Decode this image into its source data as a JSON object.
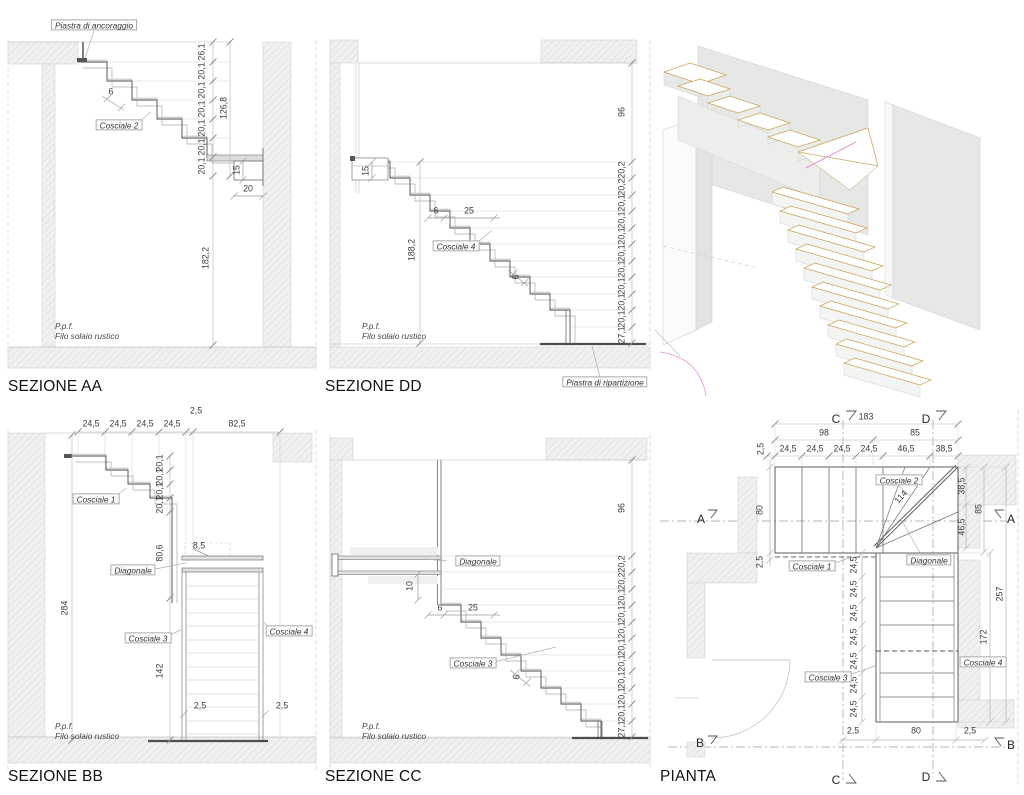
{
  "colors": {
    "hatch_line": "#d3d3d1",
    "wall_fill": "#f0f0ef",
    "line_main": "#6a6a6a",
    "line_dim": "#b4b4b4",
    "text": "#3a3a3a",
    "tan": "#c9a254",
    "magenta": "#dd7fd0"
  },
  "aa": {
    "title": "SEZIONE AA",
    "piastra": "Piastra di ancoraggio",
    "cosciale": "Cosciale 2",
    "d6": "6",
    "risers": [
      "26,1",
      "20,1",
      "20,1",
      "20,1",
      "20,1",
      "20,1",
      "20,1"
    ],
    "total": "126,8",
    "d15": "15",
    "d20": "20",
    "d182": "182,2",
    "ppf": "P.p.f.",
    "filo": "Filo solaio rustico"
  },
  "dd": {
    "title": "SEZIONE DD",
    "d96": "96",
    "d15": "15",
    "d6a": "6",
    "d25": "25",
    "cosciale": "Cosciale 4",
    "d188": "188,2",
    "d6b": "6",
    "risers": [
      "20,2",
      "20,2",
      "20,1",
      "20,1",
      "20,1",
      "20,1",
      "20,1",
      "20,1",
      "20,1",
      "20,1",
      "27,1"
    ],
    "ppf": "P.p.f.",
    "filo": "Filo solaio rustico",
    "piastra": "Piastra di ripartizione"
  },
  "bb": {
    "title": "SEZIONE BB",
    "top": [
      "24,5",
      "24,5",
      "24,5",
      "24,5"
    ],
    "d2top": "2,5",
    "d82": "82,5",
    "cosciale1": "Cosciale 1",
    "steps": [
      "20,1",
      "20,1",
      "20,1",
      "20,1"
    ],
    "d85": "8,5",
    "d806": "80,6",
    "diagonale": "Diagonale",
    "d284": "284",
    "cosciale3": "Cosciale 3",
    "cosciale4": "Cosciale 4",
    "d142": "142",
    "d25l": "2,5",
    "d25r": "2,5",
    "ppf": "P.p.f.",
    "filo": "Filo solaio rustico"
  },
  "cc": {
    "title": "SEZIONE CC",
    "diagonale": "Diagonale",
    "d10": "10",
    "d6a": "6",
    "d25": "25",
    "cosciale3": "Cosciale 3",
    "d6b": "6",
    "d96": "96",
    "risers": [
      "20,2",
      "20,2",
      "20,1",
      "20,1",
      "20,1",
      "20,1",
      "20,1",
      "20,1",
      "20,1",
      "20,1",
      "27,1"
    ],
    "ppf": "P.p.f.",
    "filo": "Filo solaio rustico"
  },
  "pl": {
    "title": "PIANTA",
    "d183": "183",
    "d98": "98",
    "d85top": "85",
    "d2tl": "2,5",
    "top": [
      "24,5",
      "24,5",
      "24,5",
      "24,5",
      "46,5",
      "38,5"
    ],
    "d80": "80",
    "d2l": "2,5",
    "d114": "114",
    "d385": "38,5",
    "d85r": "85",
    "d465": "46,5",
    "d257": "257",
    "d172": "172",
    "chain": [
      "24,5",
      "24,5",
      "24,5",
      "24,5",
      "24,5",
      "24,5",
      "24,5"
    ],
    "cosciale1": "Cosciale 1",
    "cosciale2": "Cosciale 2",
    "cosciale3": "Cosciale 3",
    "cosciale4": "Cosciale 4",
    "diagonale": "Diagonale",
    "b2l": "2,5",
    "b80": "80",
    "b2r": "2,5",
    "mA": "A",
    "mB": "B",
    "mC": "C",
    "mD": "D"
  }
}
